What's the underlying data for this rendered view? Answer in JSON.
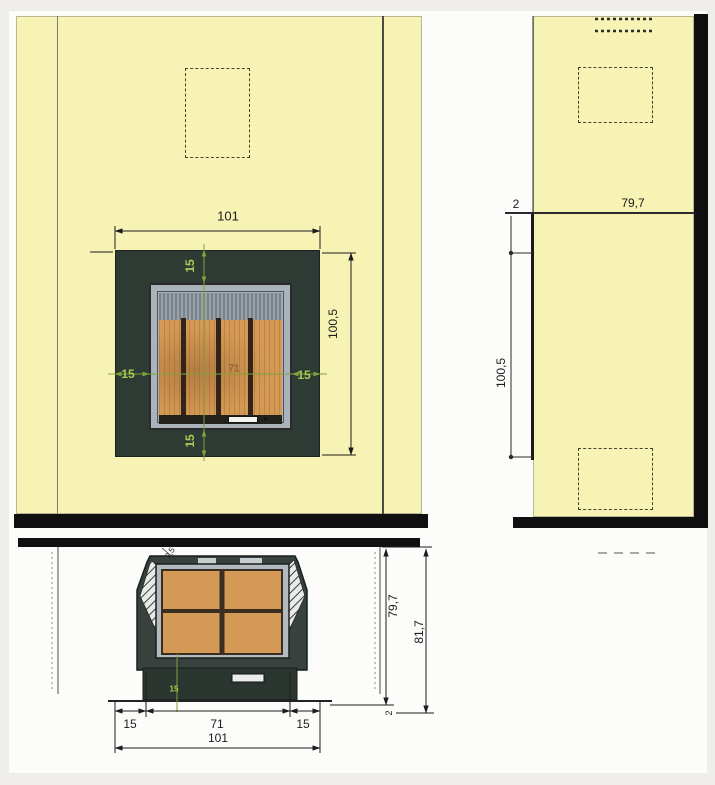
{
  "front_view": {
    "width_total": "101",
    "height_total": "100,5",
    "clearance_top": "15",
    "clearance_bottom": "15",
    "clearance_left": "15",
    "clearance_right": "15",
    "firebox_width": "71"
  },
  "side_view": {
    "wall_gap": "2",
    "depth": "79,7",
    "height": "100,5"
  },
  "plan_view": {
    "clearance_left": "15",
    "firebox_width": "71",
    "clearance_right": "15",
    "width_total": "101",
    "depth_inner": "79,7",
    "depth_total": "81,7",
    "front_gap": "2",
    "wall_note": "2,5",
    "green_note": "15"
  },
  "colors": {
    "wall_yellow": "#f7f3b4",
    "surround_dark": "#2e3a34",
    "firebox_orange": "#d49a55",
    "dimension_green": "#7ea33b",
    "linework_black": "#1c1c1c"
  }
}
